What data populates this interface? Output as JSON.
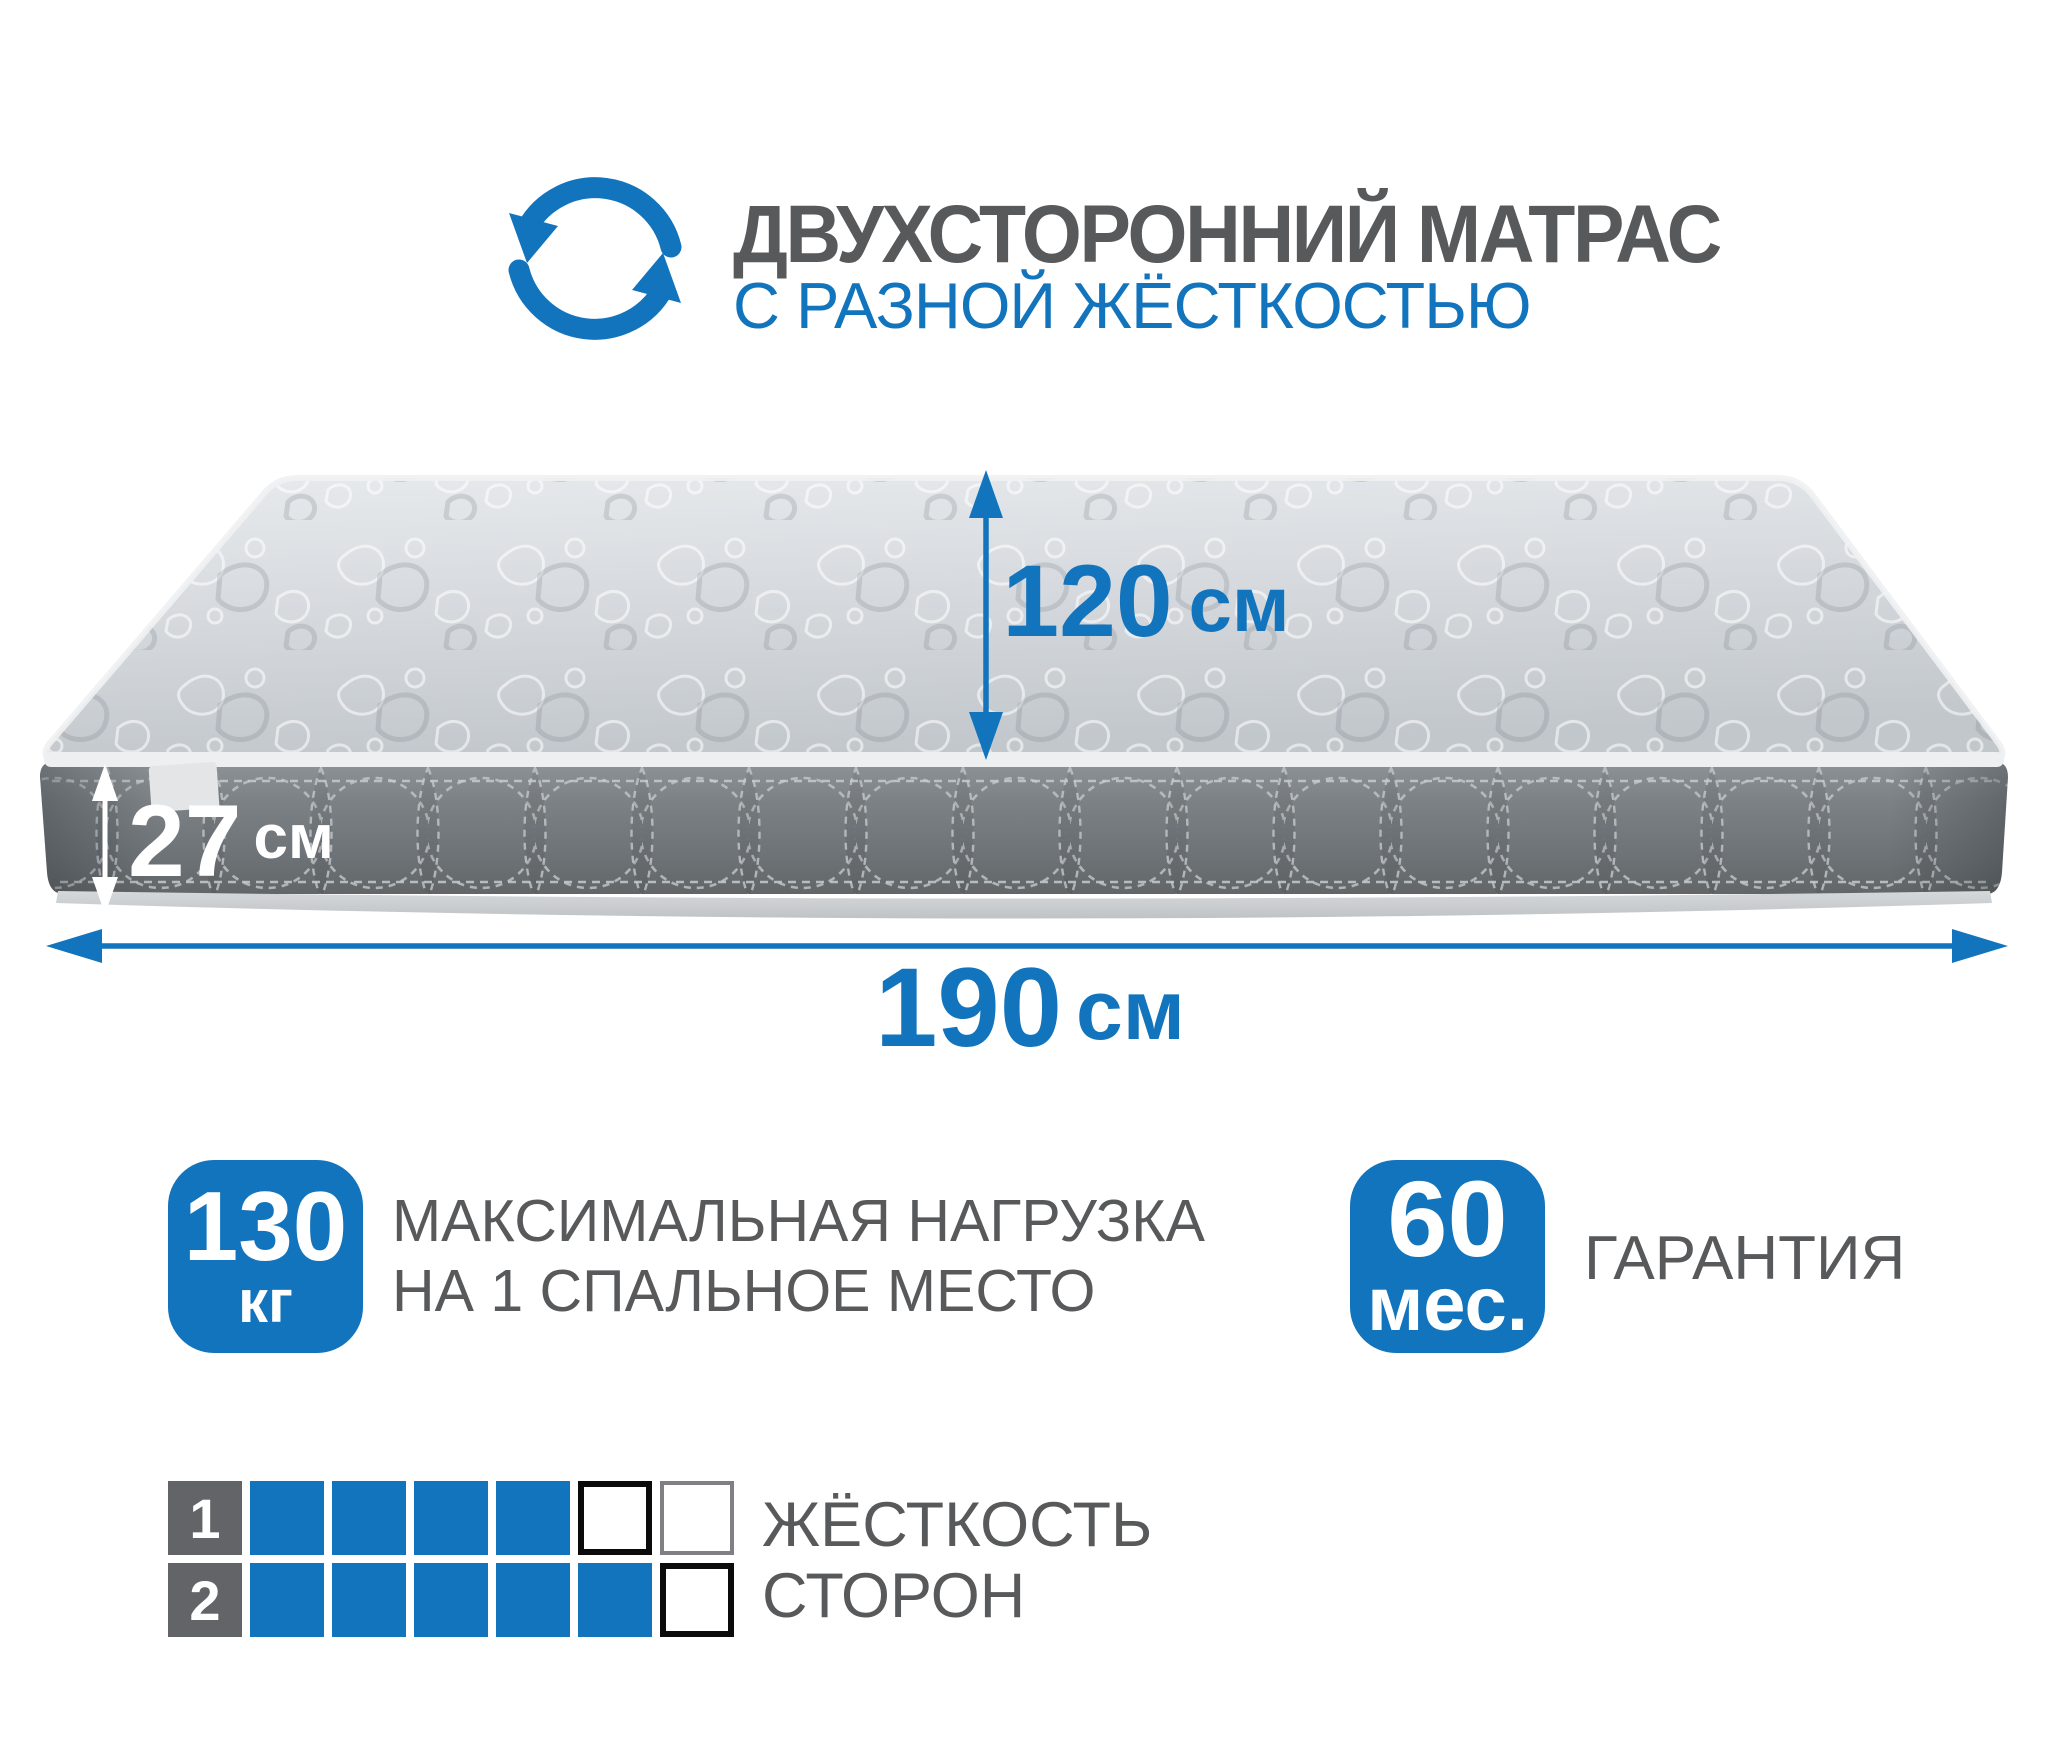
{
  "header": {
    "title": "ДВУХСТОРОННИЙ МАТРАС",
    "subtitle": "С РАЗНОЙ ЖЁСТКОСТЬЮ",
    "icon": "rotate-arrows"
  },
  "dimensions": {
    "width": {
      "value": "120",
      "unit": "см"
    },
    "height": {
      "value": "27",
      "unit": "см"
    },
    "length": {
      "value": "190",
      "unit": "см"
    }
  },
  "badges": {
    "max_load": {
      "value": "130",
      "unit": "кг",
      "caption_line1": "МАКСИМАЛЬНАЯ НАГРУЗКА",
      "caption_line2": "НА 1 СПАЛЬНОЕ МЕСТО"
    },
    "warranty": {
      "value": "60",
      "unit": "мес.",
      "caption": "ГАРАНТИЯ"
    }
  },
  "firmness": {
    "caption_line1": "ЖЁСТКОСТЬ",
    "caption_line2": "СТОРОН",
    "scale_max": 6,
    "rows": [
      {
        "label": "1",
        "filled": 4,
        "empty_borders": [
          "black",
          "gray"
        ]
      },
      {
        "label": "2",
        "filled": 5,
        "empty_borders": [
          "black"
        ]
      }
    ]
  },
  "colors": {
    "accent_blue": "#1274bc",
    "text_gray": "#58595b",
    "label_box_gray": "#626467",
    "mattress_side_gray": "#777c80",
    "mattress_top_gray": "#d7dbdf"
  }
}
